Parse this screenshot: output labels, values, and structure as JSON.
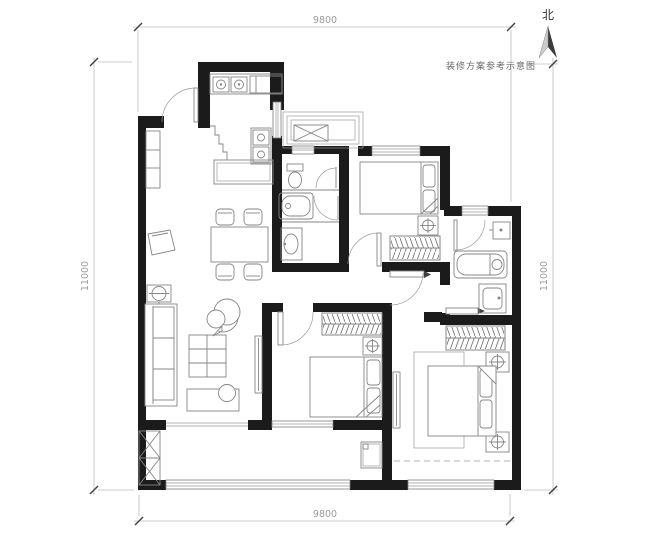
{
  "annotations": {
    "caption": "装修方案参考示意图",
    "north_label": "北"
  },
  "dimensions": {
    "top": "9800",
    "bottom": "9800",
    "left": "11000",
    "right": "11000"
  },
  "colors": {
    "background": "#ffffff",
    "wall": "#1b1b1b",
    "furniture_line": "#868686",
    "dimension_line": "#bcbcbc",
    "dimension_text": "#9b9b9b",
    "caption_text": "#6a6a6a",
    "north_dark": "#3c3c3c",
    "north_light": "#cccccc"
  }
}
